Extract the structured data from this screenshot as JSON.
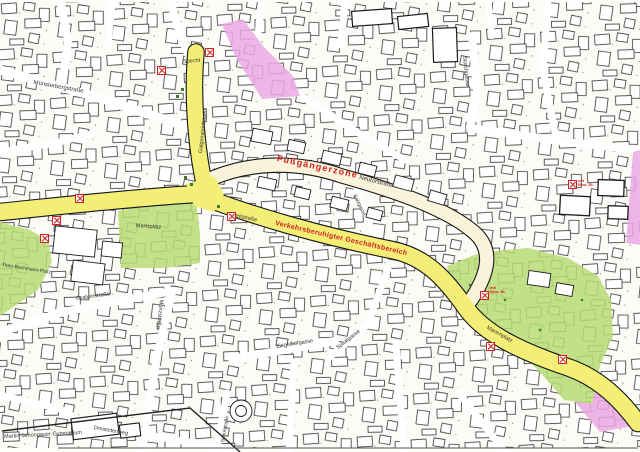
{
  "map": {
    "type": "city-plan-scan",
    "highlight_legend": {
      "pedestrian_zone_label": "Fußgängerzone",
      "traffic_calmed_label": "Verkehrsberuhigter Geschäftsbereich",
      "pedestrian_road_color": "#f8f3da",
      "business_road_color": "#f2ee76",
      "public_space_color": "#b9dc74",
      "special_area_color": "#eba8e4",
      "annotation_color": "#d42222"
    },
    "labels": [
      {
        "id": "muensterbergstrasse",
        "text": "Münsterbergstraße",
        "x": 34,
        "y": 80,
        "rot": 10,
        "fs": 6,
        "color": "#333333"
      },
      {
        "id": "specht",
        "text": "Specht",
        "x": 183,
        "y": 60,
        "rot": -4,
        "fs": 5.5,
        "color": "#333333"
      },
      {
        "id": "galgensteinbogen",
        "text": "Galgensteinbogen",
        "x": 199,
        "y": 153,
        "rot": -84,
        "fs": 5.5,
        "color": "#333333"
      },
      {
        "id": "fussgaengerzone",
        "text": "Fußgängerzone",
        "x": 278,
        "y": 154,
        "rot": 12,
        "fs": 9,
        "color": "#d42222",
        "ls": 1.2,
        "cls": "zone"
      },
      {
        "id": "neutorstrasse",
        "text": "Neutorstraße",
        "x": 360,
        "y": 175,
        "rot": 14,
        "fs": 6,
        "color": "#333333"
      },
      {
        "id": "salzgasse",
        "text": "Salzgasse",
        "x": 356,
        "y": 194,
        "rot": 64,
        "fs": 5,
        "color": "#333333"
      },
      {
        "id": "verkehrsberuhigter-geschaeftsbereich",
        "text": "Verkehrsberuhigter Geschäftsbereich",
        "x": 276,
        "y": 220,
        "rot": 13,
        "fs": 7,
        "color": "#d42222",
        "ls": 0.3,
        "cls": "zone"
      },
      {
        "id": "breitstrasse",
        "text": "Breitstraße",
        "x": 231,
        "y": 213,
        "rot": 12,
        "fs": 5.5,
        "color": "#333333"
      },
      {
        "id": "marktplatz",
        "text": "Marktplatz",
        "x": 136,
        "y": 224,
        "rot": 4,
        "fs": 5.5,
        "color": "#333333"
      },
      {
        "id": "theo-bachmann-platz",
        "text": "Theo-Bachmann-Platz",
        "x": 2,
        "y": 263,
        "rot": 9,
        "fs": 5,
        "color": "#333333"
      },
      {
        "id": "grabenstrasse",
        "text": "Grabenstraße",
        "x": 76,
        "y": 297,
        "rot": -8,
        "fs": 5.5,
        "color": "#333333"
      },
      {
        "id": "muenzstrasse",
        "text": "Münzstraße",
        "x": 163,
        "y": 300,
        "rot": 96,
        "fs": 5.5,
        "color": "#333333"
      },
      {
        "id": "ziegelhofgasse",
        "text": "Ziegelhofgasse",
        "x": 276,
        "y": 345,
        "rot": -9,
        "fs": 5.5,
        "color": "#333333"
      },
      {
        "id": "spitalgasse",
        "text": "Spitalgasse",
        "x": 336,
        "y": 347,
        "rot": -38,
        "fs": 5.5,
        "color": "#333333"
      },
      {
        "id": "marienplatz",
        "text": "Marienplatz",
        "x": 488,
        "y": 326,
        "rot": 29,
        "fs": 5.5,
        "color": "#333333"
      },
      {
        "id": "schulstrasse",
        "text": "Schulstraße",
        "x": 221,
        "y": 442,
        "rot": -80,
        "fs": 5,
        "color": "#333333"
      },
      {
        "id": "dreiseitenweg",
        "text": "Dreiseitenweg",
        "x": 94,
        "y": 426,
        "rot": 10,
        "fs": 5.5,
        "color": "#333333"
      },
      {
        "id": "storchgasse",
        "text": "Storchgasse",
        "x": 466,
        "y": 56,
        "rot": 84,
        "fs": 5.5,
        "color": "#333333"
      },
      {
        "id": "martin-schongauer-gymnasium",
        "text": "Martin-Schongauer-Gymnasium",
        "x": 4,
        "y": 435,
        "rot": -3,
        "fs": 5.5,
        "color": "#333333"
      },
      {
        "id": "note-bew-st-1",
        "text": "mit Bew.-St.",
        "x": 578,
        "y": 179,
        "rot": 0,
        "fs": 4,
        "color": "#d42222",
        "w": 16,
        "cls": "note"
      },
      {
        "id": "note-bew-st-2",
        "text": "mit Bew.-St.",
        "x": 490,
        "y": 286,
        "rot": 0,
        "fs": 4,
        "color": "#d42222",
        "w": 16,
        "cls": "note"
      }
    ],
    "markers": {
      "icon": "no-parking-icon",
      "color": "#cf1f1f",
      "points": [
        {
          "x": 205,
          "y": 48
        },
        {
          "x": 157,
          "y": 66
        },
        {
          "x": 75,
          "y": 194
        },
        {
          "x": 52,
          "y": 216
        },
        {
          "x": 40,
          "y": 234
        },
        {
          "x": 227,
          "y": 212
        },
        {
          "x": 480,
          "y": 291
        },
        {
          "x": 486,
          "y": 342
        },
        {
          "x": 558,
          "y": 355
        },
        {
          "x": 568,
          "y": 180
        }
      ]
    }
  }
}
